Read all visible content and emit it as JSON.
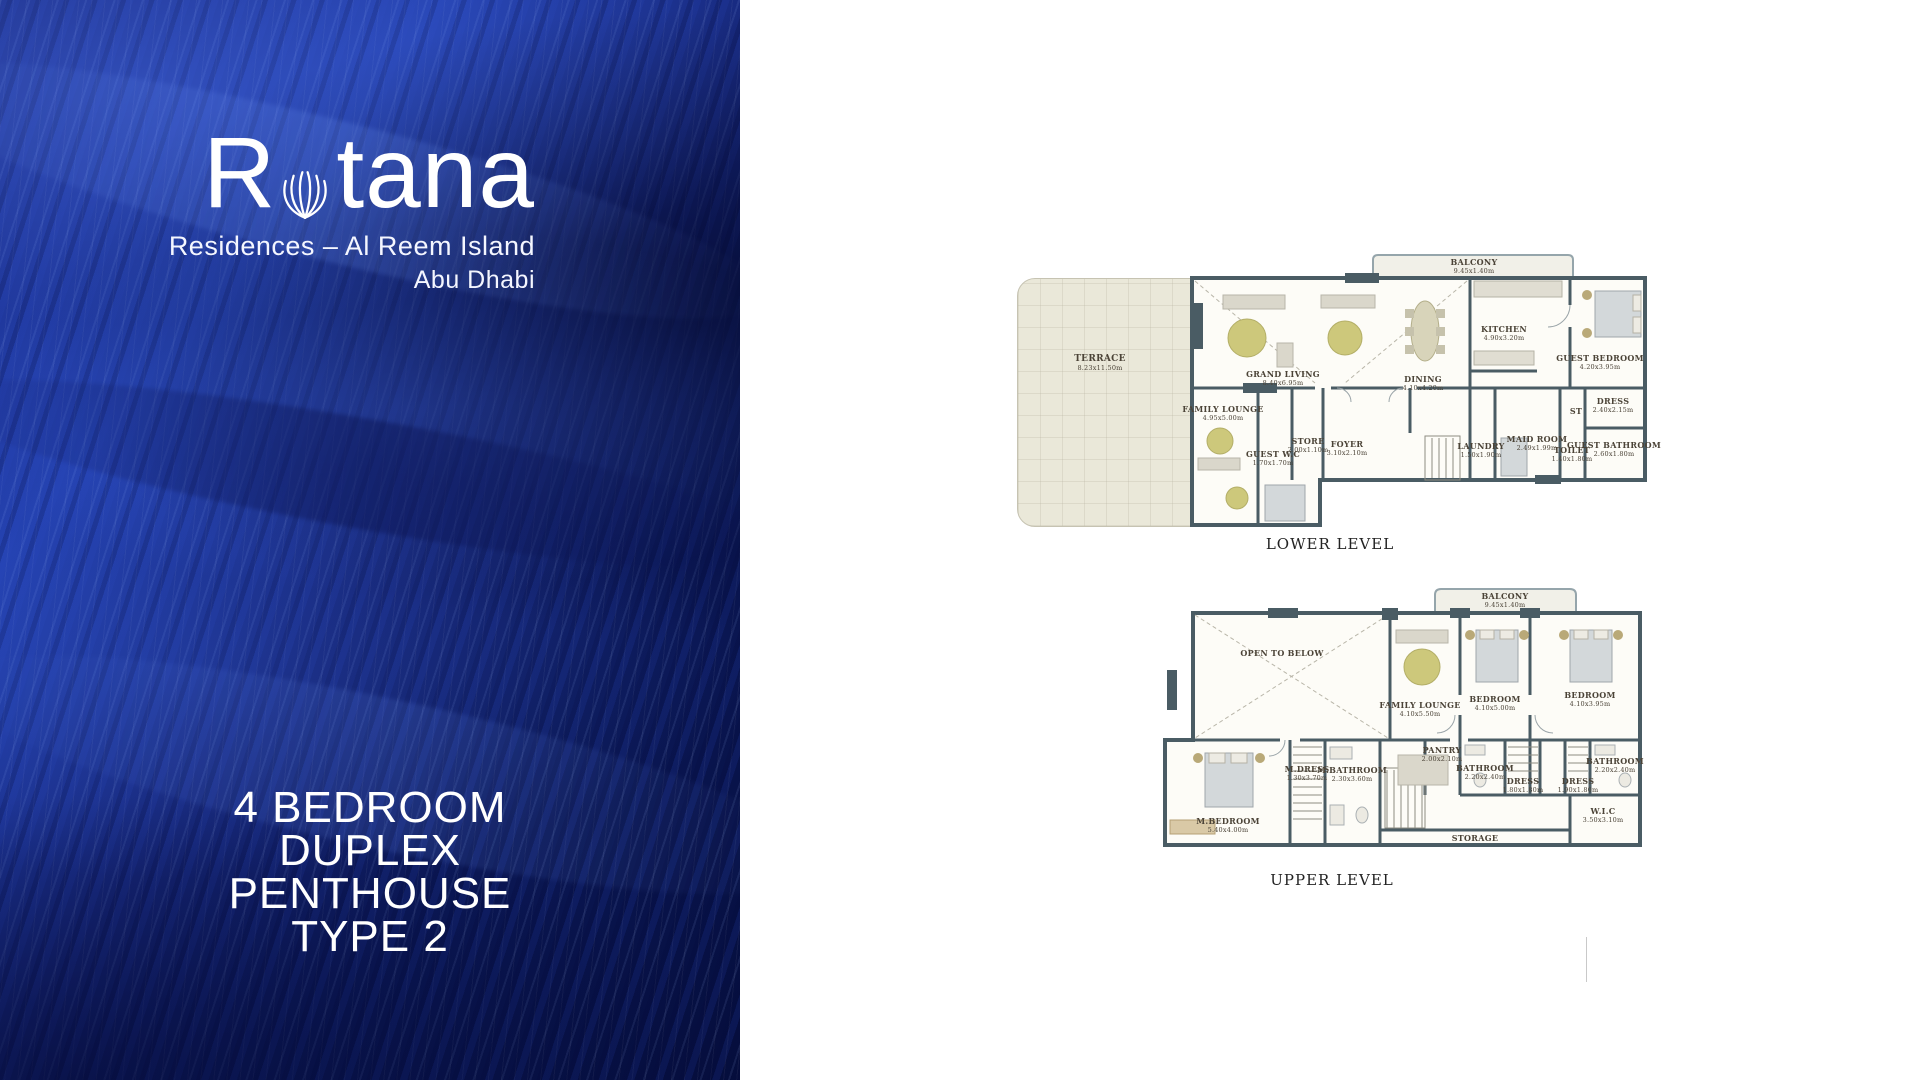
{
  "brand": {
    "logo_r": "R",
    "logo_rest": "tana",
    "subtitle_line1": "Residences – Al Reem Island",
    "subtitle_line2": "Abu Dhabi"
  },
  "title": {
    "line1": "4 BEDROOM",
    "line2": "DUPLEX",
    "line3": "PENTHOUSE",
    "line4": "TYPE 2"
  },
  "colors": {
    "panel_blue": "#1b2d86",
    "wall": "#4a5c64",
    "terrace_beige": "#eae8d9",
    "rug_olive": "#cdc87b",
    "label_text": "#4b4337"
  },
  "plans": {
    "lower": {
      "title": "LOWER LEVEL",
      "rooms": [
        {
          "name": "TERRACE",
          "dims": "8.23x11.50m"
        },
        {
          "name": "BALCONY",
          "dims": "9.45x1.40m"
        },
        {
          "name": "GRAND LIVING",
          "dims": "8.40x6.95m"
        },
        {
          "name": "DINING",
          "dims": "4.10x4.20m"
        },
        {
          "name": "KITCHEN",
          "dims": "4.90x3.20m"
        },
        {
          "name": "GUEST BEDROOM",
          "dims": "4.20x3.95m"
        },
        {
          "name": "FAMILY LOUNGE",
          "dims": "4.95x5.00m"
        },
        {
          "name": "GUEST W.C",
          "dims": "1.70x1.70m"
        },
        {
          "name": "STORE",
          "dims": "2.00x1.10m"
        },
        {
          "name": "FOYER",
          "dims": "3.10x2.10m"
        },
        {
          "name": "LAUNDRY",
          "dims": "1.50x1.90m"
        },
        {
          "name": "MAID ROOM",
          "dims": "2.49x1.99m"
        },
        {
          "name": "TOILET",
          "dims": "1.40x1.80m"
        },
        {
          "name": "GUEST BATHROOM",
          "dims": "2.60x1.80m"
        },
        {
          "name": "DRESS",
          "dims": "2.40x2.15m"
        },
        {
          "name": "ST",
          "dims": ""
        }
      ]
    },
    "upper": {
      "title": "UPPER LEVEL",
      "rooms": [
        {
          "name": "BALCONY",
          "dims": "9.45x1.40m"
        },
        {
          "name": "OPEN TO BELOW",
          "dims": ""
        },
        {
          "name": "FAMILY LOUNGE",
          "dims": "4.10x5.50m"
        },
        {
          "name": "BEDROOM",
          "dims": "4.10x5.00m"
        },
        {
          "name": "BEDROOM",
          "dims": "4.10x3.95m"
        },
        {
          "name": "M.BEDROOM",
          "dims": "5.40x4.00m"
        },
        {
          "name": "M.DRESS",
          "dims": "1.30x3.70m"
        },
        {
          "name": "M.BATHROOM",
          "dims": "2.30x3.60m"
        },
        {
          "name": "PANTRY",
          "dims": "2.00x2.10m"
        },
        {
          "name": "BATHROOM",
          "dims": "2.20x2.40m"
        },
        {
          "name": "DRESS",
          "dims": "1.80x1.80m"
        },
        {
          "name": "DRESS",
          "dims": "1.90x1.80m"
        },
        {
          "name": "BATHROOM",
          "dims": "2.20x2.40m"
        },
        {
          "name": "W.I.C",
          "dims": "3.50x3.10m"
        },
        {
          "name": "STORAGE",
          "dims": ""
        }
      ]
    }
  }
}
